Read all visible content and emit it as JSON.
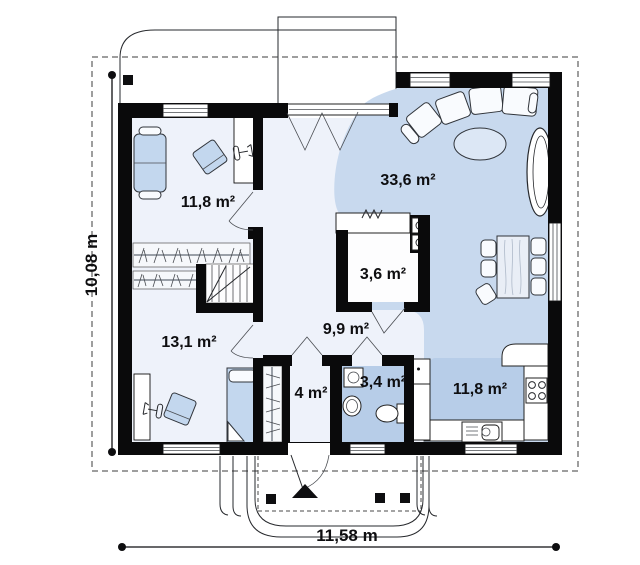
{
  "plan": {
    "type": "house-floor-plan",
    "rooms": [
      {
        "name": "bedroom-upper-left",
        "area_label": "11,8 m²"
      },
      {
        "name": "living-room",
        "area_label": "33,6 m²"
      },
      {
        "name": "pantry",
        "area_label": "3,6 m²"
      },
      {
        "name": "hallway",
        "area_label": "9,9 m²"
      },
      {
        "name": "bedroom-lower-left",
        "area_label": "13,1 m²"
      },
      {
        "name": "entry-hall",
        "area_label": "4 m²"
      },
      {
        "name": "bathroom",
        "area_label": "3,4 m²"
      },
      {
        "name": "kitchen",
        "area_label": "11,8 m²"
      }
    ],
    "dimensions": {
      "height_label": "10,08 m",
      "width_label": "11,58 m"
    },
    "colors": {
      "wall": "#0a0a0b",
      "floor_light": "#eef2fa",
      "floor_blue": "#c8d9ee",
      "floor_dark": "#b7cde8",
      "furniture_blue": "#c3d7ee"
    }
  }
}
